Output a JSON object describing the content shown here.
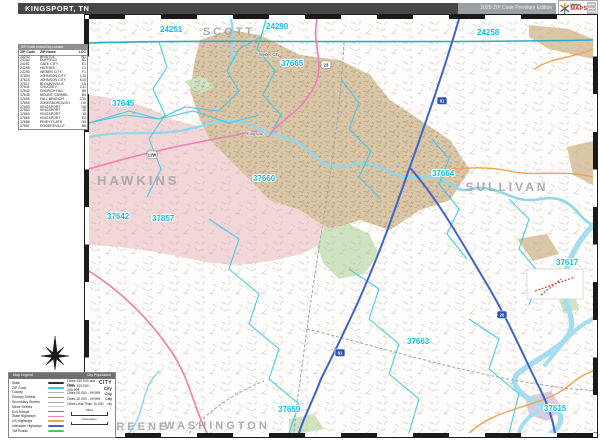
{
  "header": {
    "title": "KINGSPORT, TN",
    "edition": "2020 ZIP Code Premium Edition",
    "logo": {
      "top": "Market",
      "bottom": "MAPS"
    }
  },
  "zip_index": {
    "header": "ZIP Code Index/City Locator",
    "columns": [
      "ZIP Code",
      "ZIP Name",
      "LOC"
    ],
    "rows": [
      [
        "24202",
        "BRISTOL",
        "N1"
      ],
      [
        "24244",
        "DUFFIELD",
        "B1"
      ],
      [
        "24251",
        "GATE CITY",
        "E1"
      ],
      [
        "24258",
        "HILTONS",
        "L1"
      ],
      [
        "24290",
        "WEBER CITY",
        "F1"
      ],
      [
        "37604",
        "JOHNSON CITY",
        "L10"
      ],
      [
        "37615",
        "JOHNSON CITY",
        "K10"
      ],
      [
        "37617",
        "BLOUNTVILLE",
        "L5"
      ],
      [
        "37641",
        "CHUCKEY",
        "C11"
      ],
      [
        "37642",
        "CHURCH HILL",
        "B6"
      ],
      [
        "37645",
        "MOUNT CARMEL",
        "B3"
      ],
      [
        "37656",
        "FALL BRANCH",
        "C10"
      ],
      [
        "37659",
        "JONESBOROUGH",
        "I10"
      ],
      [
        "37660",
        "KINGSPORT",
        "G6"
      ],
      [
        "37663",
        "KINGSPORT",
        "J8"
      ],
      [
        "37664",
        "KINGSPORT",
        "I8"
      ],
      [
        "37665",
        "KINGSPORT",
        "E2"
      ],
      [
        "37686",
        "PINEY FLATS",
        "N9"
      ],
      [
        "37857",
        "ROGERSVILLE",
        "B8"
      ]
    ]
  },
  "map": {
    "county_labels": [
      {
        "name": "SCOTT",
        "x": 140,
        "y": 16,
        "size": 11,
        "anchor": "middle"
      },
      {
        "name": "HAWKINS",
        "x": 8,
        "y": 166,
        "size": 13,
        "anchor": "start"
      },
      {
        "name": "SULLIVAN",
        "x": 418,
        "y": 172,
        "size": 12,
        "anchor": "middle"
      },
      {
        "name": "GREENE",
        "x": 48,
        "y": 411,
        "size": 11,
        "anchor": "middle"
      },
      {
        "name": "WASHINGTON",
        "x": 128,
        "y": 410,
        "size": 11,
        "anchor": "middle"
      }
    ],
    "zip_labels": [
      {
        "code": "24251",
        "x": 71,
        "y": 13
      },
      {
        "code": "24290",
        "x": 177,
        "y": 10
      },
      {
        "code": "24258",
        "x": 388,
        "y": 16
      },
      {
        "code": "37665",
        "x": 192,
        "y": 47
      },
      {
        "code": "37645",
        "x": 23,
        "y": 87
      },
      {
        "code": "37660",
        "x": 164,
        "y": 162
      },
      {
        "code": "37664",
        "x": 343,
        "y": 157
      },
      {
        "code": "37642",
        "x": 18,
        "y": 200
      },
      {
        "code": "37857",
        "x": 63,
        "y": 202
      },
      {
        "code": "37617",
        "x": 467,
        "y": 246
      },
      {
        "code": "37663",
        "x": 318,
        "y": 325
      },
      {
        "code": "37659",
        "x": 189,
        "y": 393
      },
      {
        "code": "37615",
        "x": 455,
        "y": 392
      }
    ],
    "city_labels": [
      {
        "name": "Kingsport",
        "x": 158,
        "y": 116
      },
      {
        "name": "Weber City",
        "x": 170,
        "y": 37
      }
    ],
    "shields": [
      {
        "kind": "interstate",
        "num": "81",
        "x": 348,
        "y": 78
      },
      {
        "kind": "interstate",
        "num": "81",
        "x": 246,
        "y": 330
      },
      {
        "kind": "interstate",
        "num": "26",
        "x": 408,
        "y": 292
      },
      {
        "kind": "us",
        "num": "23",
        "x": 232,
        "y": 42
      },
      {
        "kind": "us",
        "num": "11W",
        "x": 58,
        "y": 132
      }
    ]
  },
  "legend": {
    "title_left": "Map Legend",
    "title_right": "City Population",
    "items": [
      {
        "label": "State",
        "color": "#333333",
        "h": 2.4
      },
      {
        "label": "ZIP Code",
        "color": "#35c8e8",
        "h": 2.4
      },
      {
        "label": "County",
        "color": "#b5b5b5",
        "h": 1.4
      },
      {
        "label": "Primary Streets",
        "color": "#8a8a8a",
        "h": 1.4
      },
      {
        "label": "Secondary Streets",
        "color": "#ababab",
        "h": 1.0
      },
      {
        "label": "Minor Streets",
        "color": "#cccccc",
        "h": 1.0
      },
      {
        "label": "Exit Ramps",
        "color": "#e05050",
        "h": 1.0
      },
      {
        "label": "State Highways",
        "color": "#ee7fb2",
        "h": 1.6
      },
      {
        "label": "US Highways",
        "color": "#f2a24b",
        "h": 1.6
      },
      {
        "label": "Interstate Highways",
        "color": "#3f63c8",
        "h": 2.0
      },
      {
        "label": "Toll Roads",
        "color": "#56c05a",
        "h": 2.0
      }
    ],
    "cities": [
      {
        "label": "Cities 250,000 and Over",
        "sample": "CITY",
        "cls": "c1"
      },
      {
        "label": "Cities 100,000 - 249,999",
        "sample": "City",
        "cls": "c2"
      },
      {
        "label": "Cities 50,000 - 99,999",
        "sample": "City",
        "cls": "c3"
      },
      {
        "label": "Cities 10,000 - 49,999",
        "sample": "City",
        "cls": "c4"
      },
      {
        "label": "Cities Less Than 10,000",
        "sample": "city",
        "cls": "c5"
      }
    ],
    "scales": [
      "Miles",
      "Kilometers"
    ]
  },
  "colors": {
    "zip_label": "#12c0e8",
    "county_label": "#a5a5a5",
    "pink_region": "#f3d7d8",
    "urban_region": "#dbc7a6",
    "park_green": "#cfe3c0",
    "water": "#8fd8ee",
    "interstate": "#3f63c8",
    "us_highway": "#ee7fb2",
    "state_line": "#2fa9c4"
  }
}
